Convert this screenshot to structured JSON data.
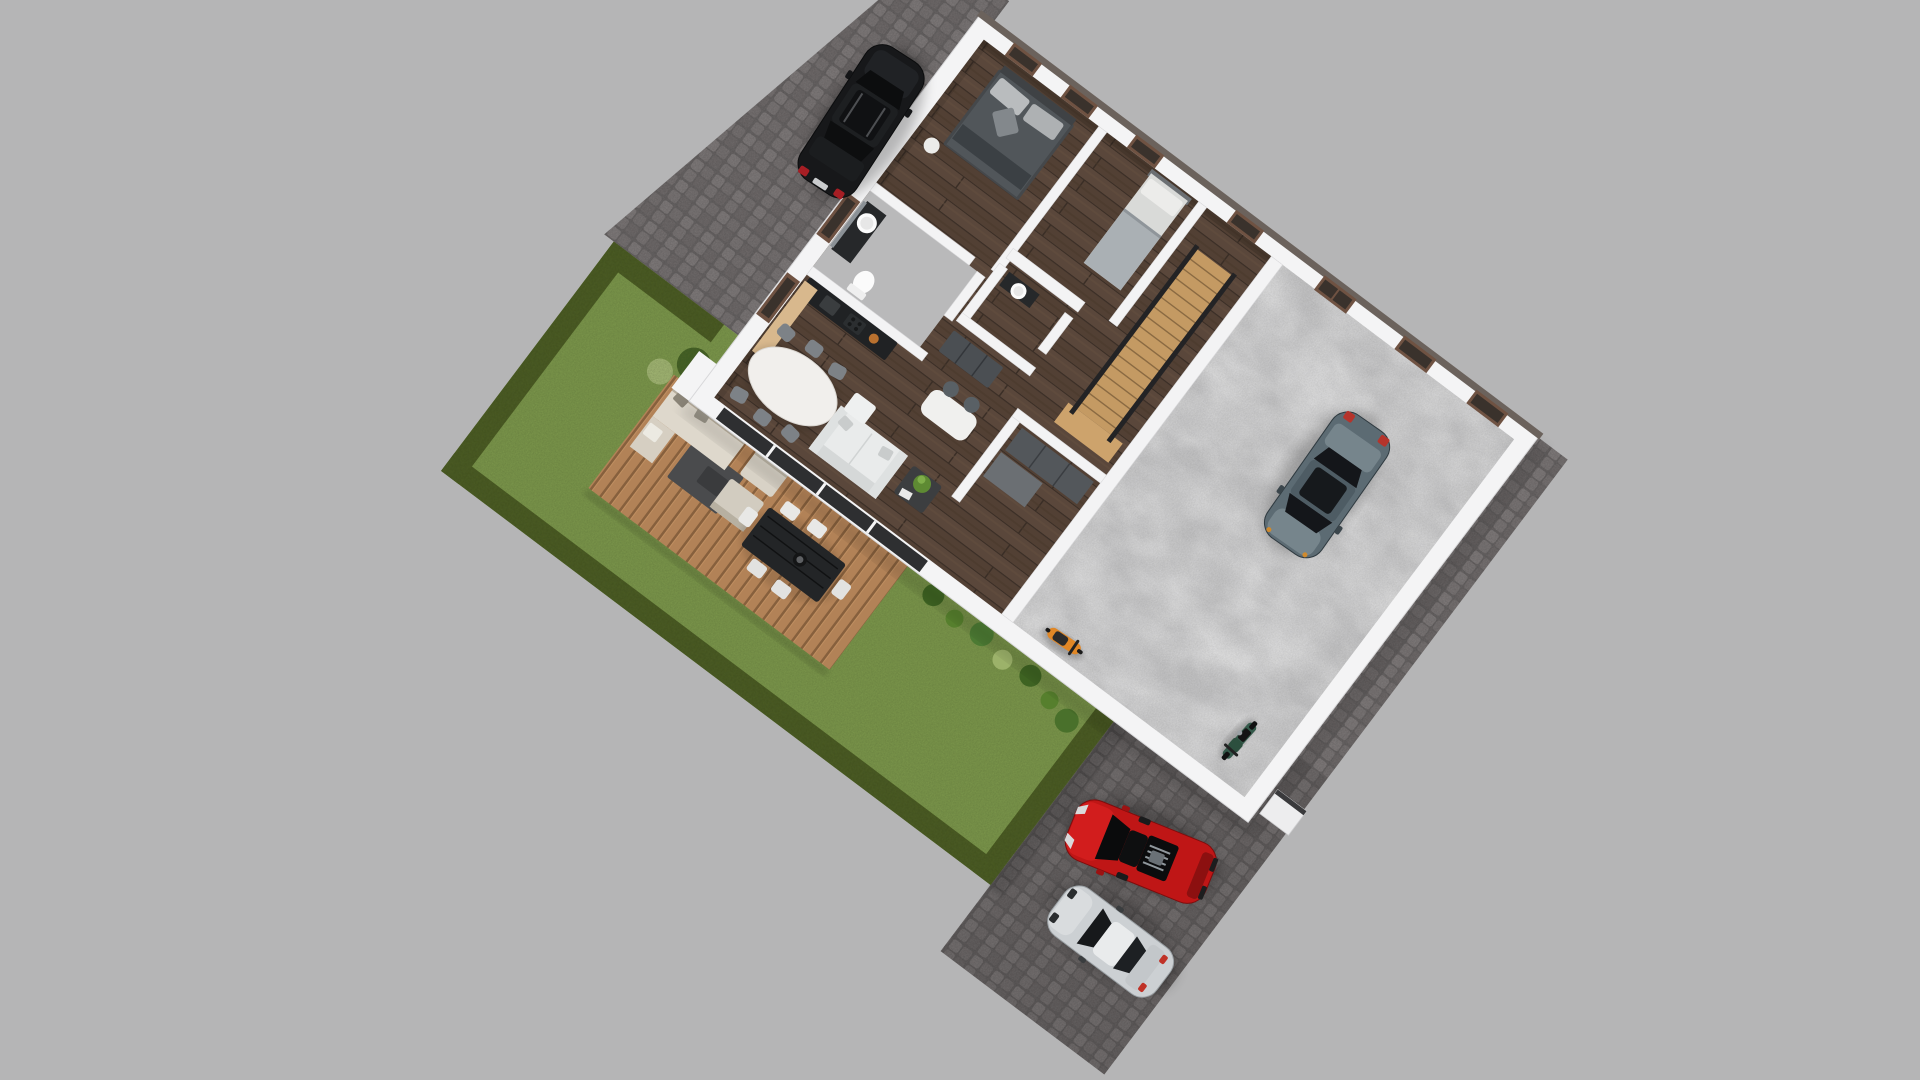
{
  "scene": {
    "description": "Aerial 3D render of a single-storey house floor plan on a rotated lot with cobblestone driveway, walled garden with hedge, wooden terrace and parked vehicles",
    "view": "top-down oblique",
    "rooms": [
      {
        "id": "master-bedroom",
        "furniture": [
          "double-bed",
          "headboard",
          "pillows",
          "round-nightstand"
        ]
      },
      {
        "id": "bathroom",
        "furniture": [
          "vanity-sink",
          "mirror",
          "toilet"
        ]
      },
      {
        "id": "second-bedroom",
        "furniture": [
          "single-bed",
          "pillow"
        ]
      },
      {
        "id": "wc",
        "furniture": [
          "vanity-sink"
        ]
      },
      {
        "id": "hallway",
        "furniture": [
          "sideboard"
        ]
      },
      {
        "id": "stair-hall",
        "furniture": [
          "wooden-staircase",
          "dark-railing"
        ]
      },
      {
        "id": "closet-room",
        "furniture": [
          "wardrobe",
          "low-cabinet"
        ]
      },
      {
        "id": "open-kitchen-living",
        "furniture": [
          "black-kitchen-counter",
          "wood-shelf",
          "island-with-stools",
          "oval-dining-table",
          "six-chairs",
          "white-sofa",
          "coffee-table-with-plant"
        ]
      },
      {
        "id": "garage-hall",
        "furniture": [
          "concrete-floor"
        ]
      }
    ],
    "vehicles": [
      {
        "id": "black-suv",
        "location": "driveway-top"
      },
      {
        "id": "gray-sedan",
        "location": "inside-garage-hall"
      },
      {
        "id": "red-sports-car",
        "location": "driveway-bottom"
      },
      {
        "id": "silver-hatchback",
        "location": "driveway-bottom"
      },
      {
        "id": "orange-scooter",
        "location": "garage-hall-wall"
      },
      {
        "id": "green-motorbike",
        "location": "garage-hall-corner"
      }
    ],
    "garden": {
      "elements": [
        "lawn",
        "hedge-border",
        "wood-deck",
        "lounge-set",
        "outdoor-dining-set",
        "potted-plants-row",
        "corner-bushes"
      ]
    }
  },
  "colors": {
    "bg": "#b5b5b6",
    "pave": "#7b7777",
    "pave_shade": "#000000",
    "grass": "#7e9a4d",
    "hedge": "#41501e",
    "wall": "#f4f4f5",
    "wall_cap": "#6b625c",
    "concrete": "#c7c7c8",
    "bath_floor": "#b9b9ba",
    "stairs": "#c49a63",
    "railing": "#232325",
    "glass": "#2e2f31",
    "window_frame": "#6f5242",
    "window_glass": "#3a322c",
    "counter": "#202224",
    "shelf": "#d8b88d",
    "island": "#f0f0ee",
    "table_white": "#f1efec",
    "chair": "#7d8287",
    "sofa": "#e9ebeb",
    "coffee_table": "#3c3e40",
    "plant": "#5e8a33",
    "wardrobe": "#53575b",
    "sideboard": "#4b4f53",
    "bed_duvet": "#51565a",
    "headboard": "#3f4245",
    "pillow": "#b9bcbe",
    "bed_light": "#d9dad8",
    "blanket_light": "#aab0b4",
    "vanity": "#26282a",
    "porcelain": "#fbfbfb",
    "deck_table": "#232527",
    "deck_chair": "#e8e8e6",
    "lounge": "#ded8cc",
    "lounge_mat": "#4a4b4d",
    "car_suv": "#17181a",
    "car_sedan": "#5c6b73",
    "car_sedan_trunk": "#76858c",
    "car_red": "#bf1616",
    "car_silver": "#ccd0d3",
    "scooter": "#e08726",
    "moto": "#34594a",
    "taillight": "#a61e24",
    "pot": "#3a3a3a",
    "bush_dark": "#3a5a22",
    "bush_mid": "#567f2d",
    "bush_light": "#a8bd77"
  }
}
